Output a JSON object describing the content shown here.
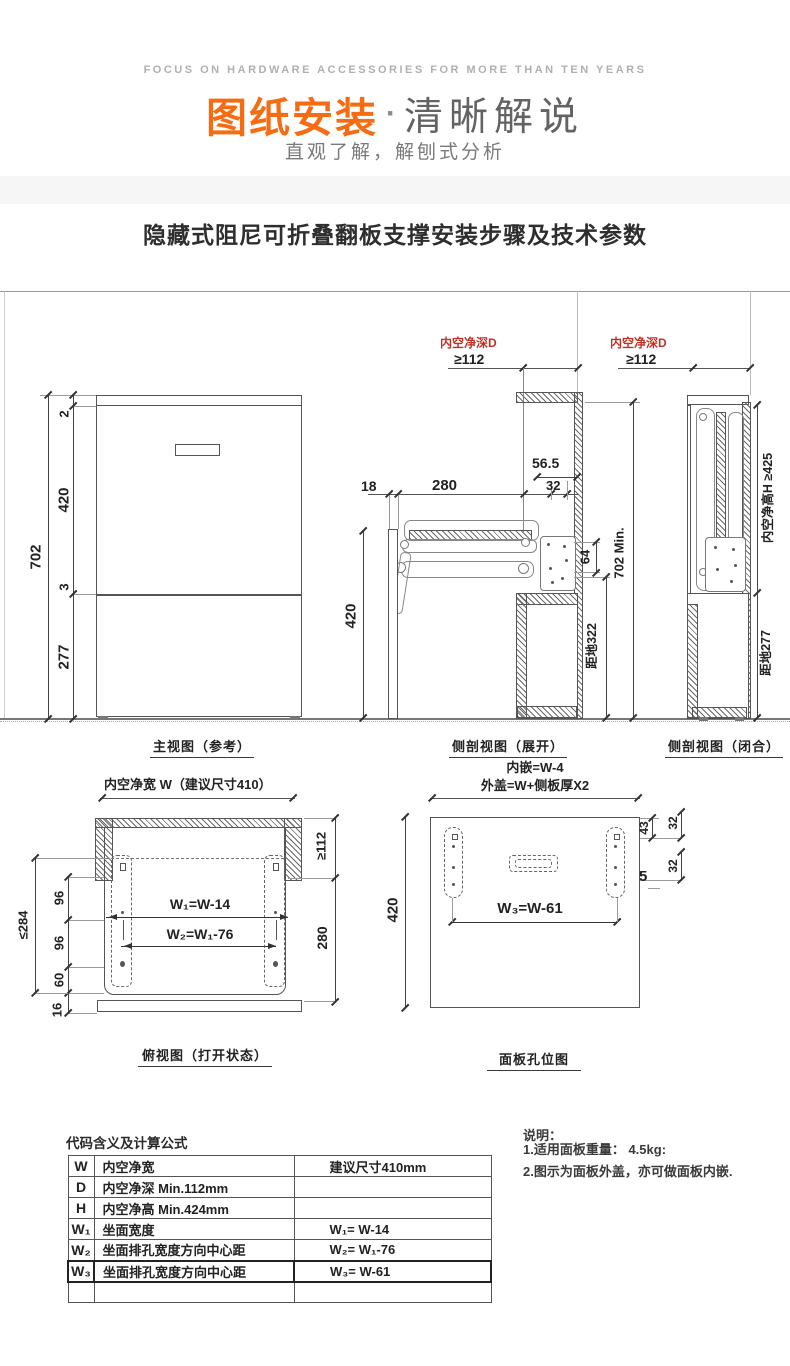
{
  "header": {
    "tagline": "FOCUS ON HARDWARE ACCESSORIES FOR MORE THAN TEN YEARS",
    "banner_orange": "图纸安装",
    "banner_sep": "·",
    "banner_gray": "清晰解说",
    "subtitle": "直观了解，解刨式分析"
  },
  "page_title": "隐藏式阻尼可折叠翻板支撑安装步骤及技术参数",
  "colors": {
    "accent_orange": "#f66c12",
    "dim_red": "#bf3124",
    "line": "#555555"
  },
  "views": {
    "front": {
      "caption": "主视图（参考）",
      "dim_total": "702",
      "dim_top": "2",
      "dim_door": "420",
      "dim_gap": "3",
      "dim_bottom": "277"
    },
    "side_open": {
      "caption": "侧剖视图（展开）",
      "depth_label": "内空净深D",
      "depth_min": "≥112",
      "dim_18": "18",
      "dim_280": "280",
      "dim_565": "56.5",
      "dim_32": "32",
      "dim_420": "420",
      "dim_64": "64",
      "dim_702min": "702 Min.",
      "dim_ground": "距地322"
    },
    "side_closed": {
      "caption": "侧剖视图（闭合）",
      "depth_label": "内空净深D",
      "depth_min": "≥112",
      "dim_height": "内空净高H ≥425",
      "dim_ground": "距地277"
    },
    "top_open": {
      "caption": "俯视图（打开状态）",
      "width_label": "内空净宽 W（建议尺寸410）",
      "formula_w1": "W₁=W-14",
      "formula_w2": "W₂=W₁-76",
      "dim_112": "≥112",
      "dim_280": "280",
      "dim_96a": "96",
      "dim_96b": "96",
      "dim_60": "60",
      "dim_16": "16",
      "dim_284": "≤284"
    },
    "panel": {
      "caption": "面板孔位图",
      "inset_label": "内嵌=W-4",
      "overlay_label": "外盖=W+侧板厚X2",
      "formula_w3": "W₃=W-61",
      "dim_420": "420",
      "dim_43": "43",
      "dim_32a": "32",
      "dim_32b": "32",
      "dim_5": "5"
    }
  },
  "table": {
    "title": "代码含义及计算公式",
    "rows": [
      {
        "code": "W",
        "desc": "内空净宽",
        "formula": "建议尺寸410mm"
      },
      {
        "code": "D",
        "desc": "内空净深 Min.112mm",
        "formula": ""
      },
      {
        "code": "H",
        "desc": "内空净高 Min.424mm",
        "formula": ""
      },
      {
        "code": "W₁",
        "desc": "坐面宽度",
        "formula": "W₁= W-14"
      },
      {
        "code": "W₂",
        "desc": "坐面排孔宽度方向中心距",
        "formula": "W₂= W₁-76"
      },
      {
        "code": "W₃",
        "desc": "坐面排孔宽度方向中心距",
        "formula": "W₃= W-61"
      },
      {
        "code": "",
        "desc": "",
        "formula": ""
      }
    ]
  },
  "notes": {
    "title": "说明：",
    "item1": "1.适用面板重量：  4.5kg:",
    "item2": "2.图示为面板外盖，亦可做面板内嵌."
  }
}
